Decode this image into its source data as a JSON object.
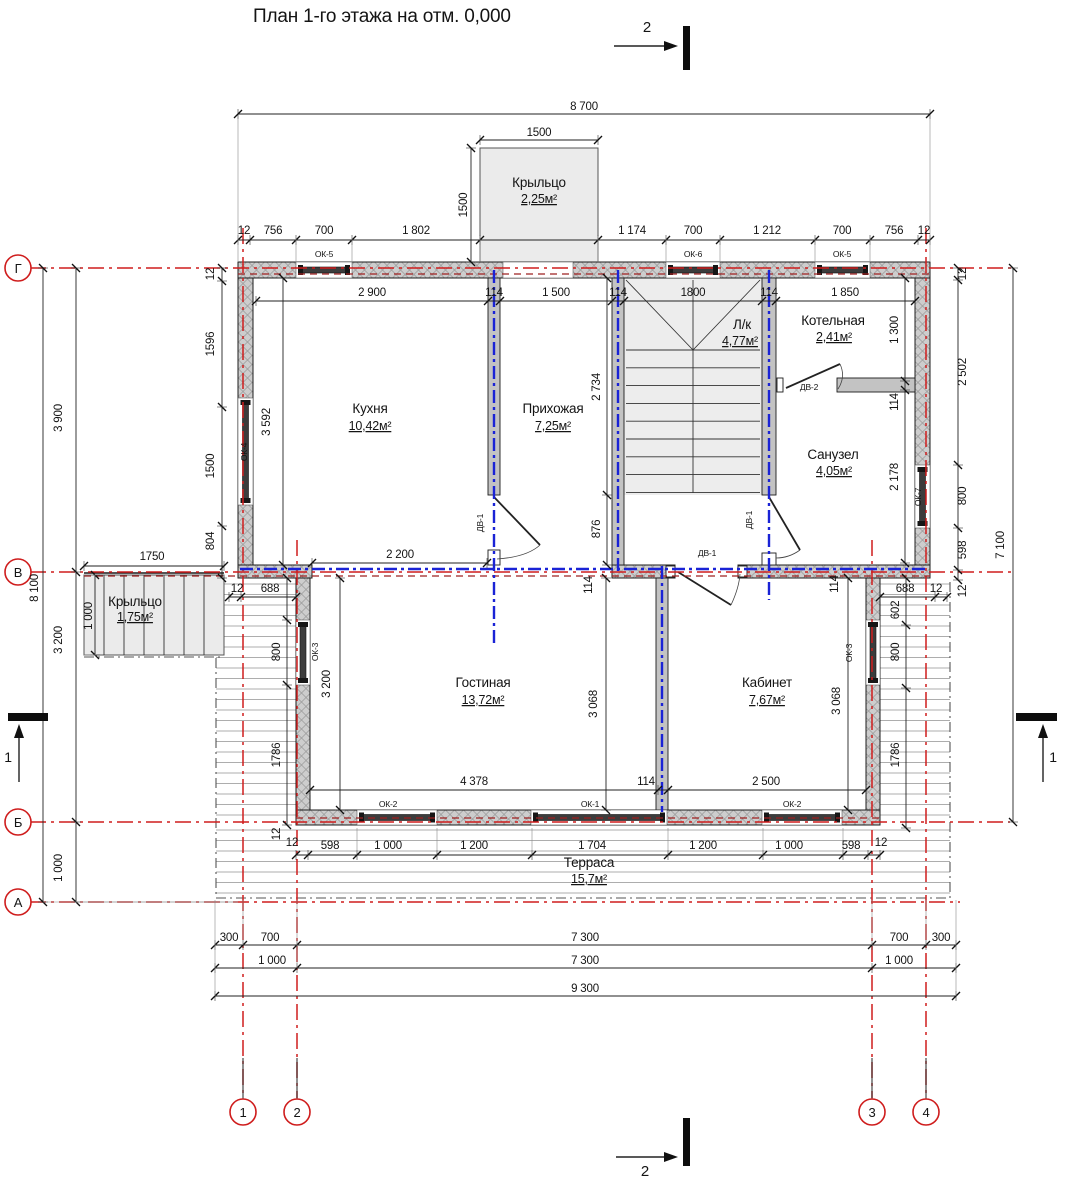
{
  "title": "План 1-го этажа на отм. 0,000",
  "colors": {
    "axis_red": "#cf1d1d",
    "frame_blue": "#1a23d6",
    "wall_grey": "#cdcdcd",
    "dim_black": "#141414"
  },
  "section_markers": {
    "top": "2",
    "bottom": "2",
    "left": "1",
    "right": "1"
  },
  "axes": {
    "horizontal": [
      "Г",
      "В",
      "Б",
      "А"
    ],
    "vertical": [
      "1",
      "2",
      "3",
      "4"
    ]
  },
  "rooms": [
    {
      "name": "Крыльцо",
      "area": "2,25м²"
    },
    {
      "name": "Кухня",
      "area": "10,42м²"
    },
    {
      "name": "Прихожая",
      "area": "7,25м²"
    },
    {
      "name": "Л/к",
      "area": "4,77м²"
    },
    {
      "name": "Котельная",
      "area": "2,41м²"
    },
    {
      "name": "Санузел",
      "area": "4,05м²"
    },
    {
      "name": "Крыльцо",
      "area": "1,75м²"
    },
    {
      "name": "Гостиная",
      "area": "13,72м²"
    },
    {
      "name": "Кабинет",
      "area": "7,67м²"
    },
    {
      "name": "Терраса",
      "area": "15,7м²"
    }
  ],
  "window_labels": {
    "ok1": "ОК-1",
    "ok2": "ОК-2",
    "ok3": "ОК-3",
    "ok4": "ОК-4",
    "ok5": "ОК-5",
    "ok6": "ОК-6",
    "ok7": "ОК-7"
  },
  "door_labels": {
    "dv1": "ДВ-1",
    "dv2": "ДВ-2"
  },
  "dims": {
    "top_overall": "8 700",
    "porch_top_w": "1500",
    "porch_top_h": "1500",
    "top_chain": [
      "12",
      "756",
      "700",
      "1 802",
      "1 174",
      "700",
      "1 212",
      "700",
      "756",
      "12"
    ],
    "top_interior": [
      "2 900",
      "114",
      "1 500",
      "114",
      "1800",
      "114",
      "1 850"
    ],
    "left_overall": "8 100",
    "left_spans": [
      "3 900",
      "3 200",
      "1 000"
    ],
    "left_chain": [
      "12",
      "1596",
      "1500",
      "804"
    ],
    "porch_left_w": "1750",
    "porch_left_h": "1 000",
    "kitchen_h": "3 592",
    "kitchen_w_bottom": "2 200",
    "hall_h": "2 734",
    "hall_h2": "876",
    "boiler_h": "1 300",
    "wall_114": "114",
    "san_h": "2 178",
    "right_chain": [
      "12",
      "2 502",
      "800",
      "598",
      "12"
    ],
    "right_overall": "7 100",
    "living_h": "3 200",
    "living_w": "4 378",
    "living_h2": "3 068",
    "cab_w": "2 500",
    "cab_h": "3 068",
    "terrace_left_chain": [
      "12",
      "688",
      "800",
      "1786",
      "12"
    ],
    "terrace_right_chain": [
      "688",
      "12",
      "602",
      "800",
      "1786"
    ],
    "bottom_chain": [
      "12",
      "598",
      "1 000",
      "1 200",
      "1 704",
      "1 200",
      "1 000",
      "598",
      "12"
    ],
    "bottom_row1": [
      "300",
      "700",
      "7 300",
      "700",
      "300"
    ],
    "bottom_row2": [
      "1 000",
      "7 300",
      "1 000"
    ],
    "bottom_row3": "9 300"
  }
}
